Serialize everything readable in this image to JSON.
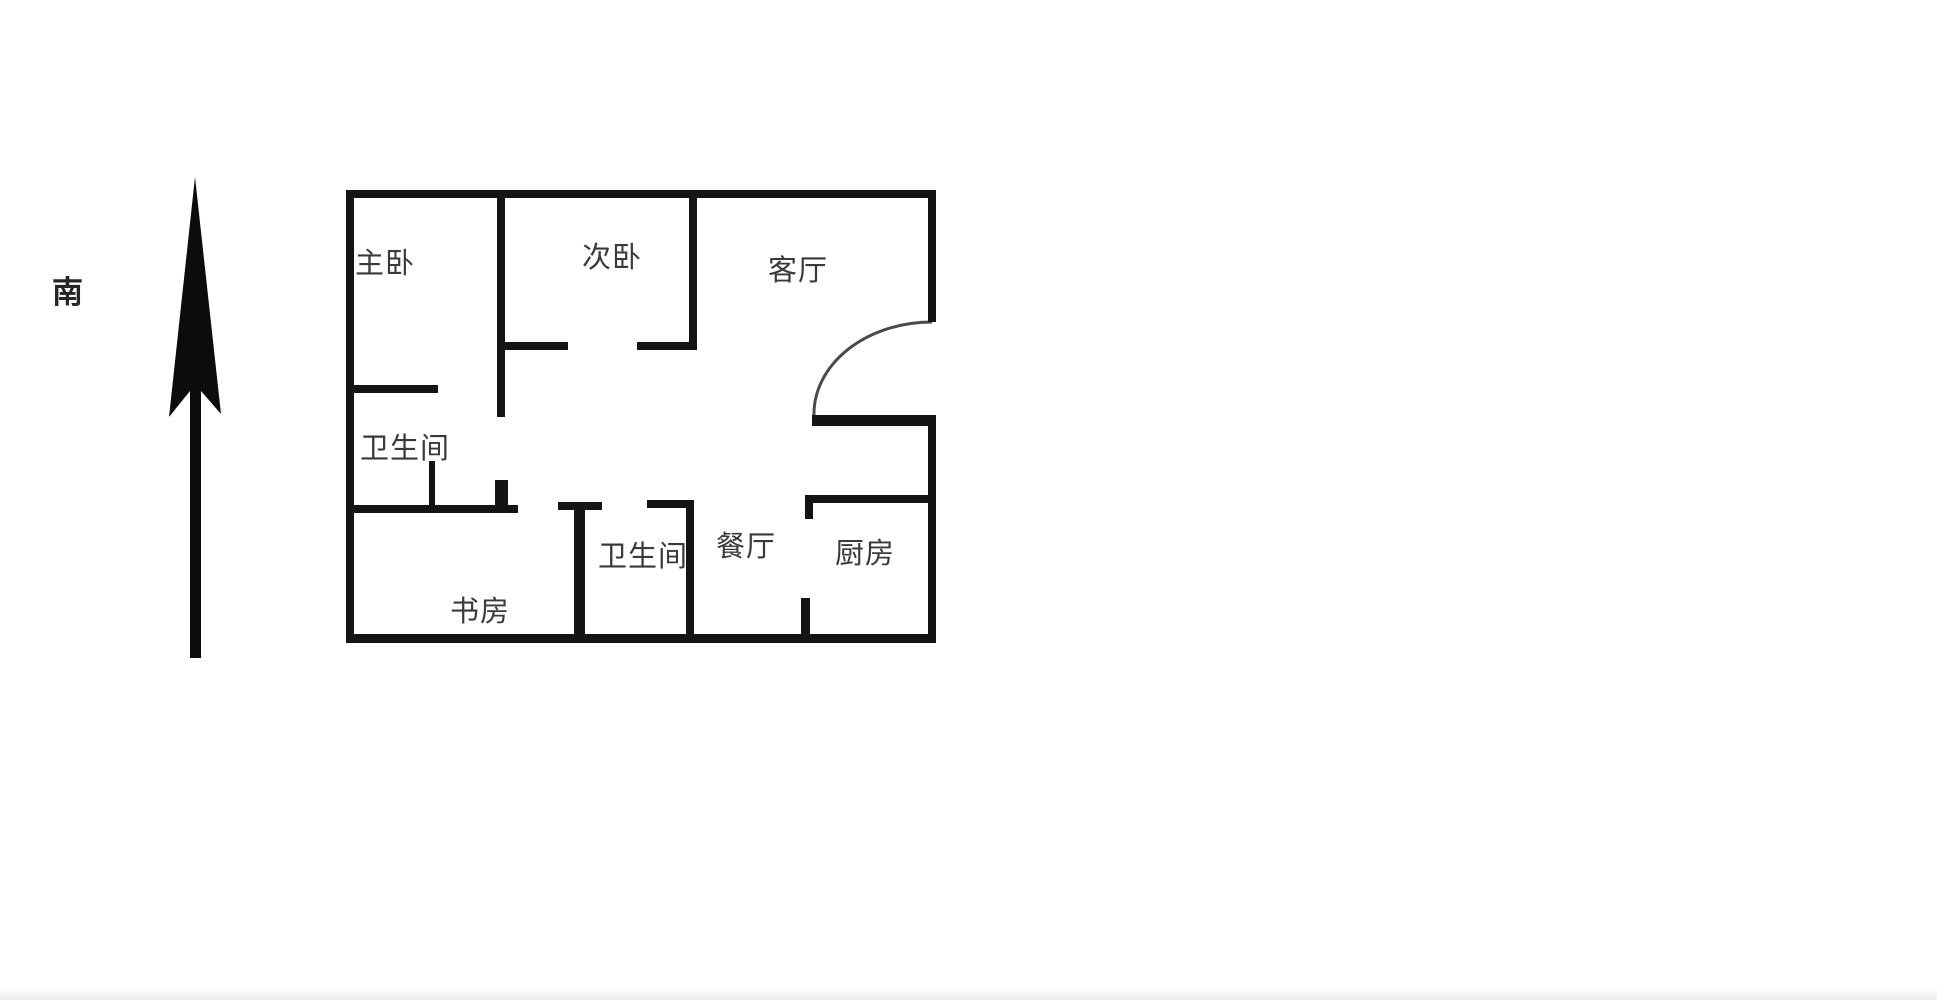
{
  "colors": {
    "background": "#ffffff",
    "wall": "#141414",
    "text": "#3a3a3a",
    "door_arc": "#4a4a4a",
    "compass": "#0c0c0c"
  },
  "compass": {
    "label": "南",
    "label_x": 52,
    "label_y": 277,
    "arrow_points": "195,177 221,414 201,391 201,658 190,658 190,391 169,417"
  },
  "floorplan": {
    "door_arc_path": "M 932 322 A 118 92 0 0 0 814 415",
    "rooms": [
      {
        "id": "master-bedroom",
        "label": "主卧",
        "x": 355,
        "y": 249
      },
      {
        "id": "second-bedroom",
        "label": "次卧",
        "x": 582,
        "y": 243
      },
      {
        "id": "living-room",
        "label": "客厅",
        "x": 768,
        "y": 256
      },
      {
        "id": "bathroom-1",
        "label": "卫生间",
        "x": 360,
        "y": 434
      },
      {
        "id": "bathroom-2",
        "label": "卫生间",
        "x": 598,
        "y": 542
      },
      {
        "id": "dining-room",
        "label": "餐厅",
        "x": 716,
        "y": 532
      },
      {
        "id": "kitchen",
        "label": "厨房",
        "x": 835,
        "y": 539
      },
      {
        "id": "study",
        "label": "书房",
        "x": 450,
        "y": 597
      }
    ],
    "walls": [
      {
        "name": "wall-outer-top",
        "x": 346,
        "y": 190,
        "w": 590,
        "h": 8
      },
      {
        "name": "wall-outer-left",
        "x": 346,
        "y": 190,
        "w": 8,
        "h": 453
      },
      {
        "name": "wall-outer-bottom",
        "x": 346,
        "y": 634,
        "w": 590,
        "h": 9
      },
      {
        "name": "wall-outer-right-upper",
        "x": 928,
        "y": 190,
        "w": 8,
        "h": 132
      },
      {
        "name": "wall-outer-right-lower",
        "x": 928,
        "y": 417,
        "w": 8,
        "h": 226
      },
      {
        "name": "wall-bedroom-divider",
        "x": 497,
        "y": 190,
        "w": 8,
        "h": 227
      },
      {
        "name": "wall-master-bottom",
        "x": 346,
        "y": 385,
        "w": 92,
        "h": 8
      },
      {
        "name": "wall-bedroom2-right",
        "x": 689,
        "y": 190,
        "w": 8,
        "h": 160
      },
      {
        "name": "wall-bedroom2-bottom-left",
        "x": 497,
        "y": 342,
        "w": 71,
        "h": 8
      },
      {
        "name": "wall-bedroom2-bottom-right",
        "x": 637,
        "y": 342,
        "w": 60,
        "h": 8
      },
      {
        "name": "wall-bath1-door-line",
        "x": 429,
        "y": 461,
        "w": 6,
        "h": 46
      },
      {
        "name": "wall-study-top",
        "x": 346,
        "y": 505,
        "w": 172,
        "h": 8
      },
      {
        "name": "wall-study-door-jamb",
        "x": 495,
        "y": 480,
        "w": 13,
        "h": 27
      },
      {
        "name": "wall-entry-hall",
        "x": 812,
        "y": 415,
        "w": 124,
        "h": 11
      },
      {
        "name": "wall-kitchen-top",
        "x": 805,
        "y": 495,
        "w": 131,
        "h": 8
      },
      {
        "name": "wall-kitchen-top-stub",
        "x": 805,
        "y": 495,
        "w": 8,
        "h": 24
      },
      {
        "name": "wall-kitchen-door-stub",
        "x": 801,
        "y": 598,
        "w": 9,
        "h": 38
      },
      {
        "name": "wall-bath2-left",
        "x": 574,
        "y": 502,
        "w": 11,
        "h": 132
      },
      {
        "name": "wall-bath2-top-left",
        "x": 558,
        "y": 502,
        "w": 44,
        "h": 8
      },
      {
        "name": "wall-bath2-top-right",
        "x": 647,
        "y": 500,
        "w": 46,
        "h": 8
      },
      {
        "name": "wall-bath2-right",
        "x": 686,
        "y": 500,
        "w": 8,
        "h": 136
      }
    ]
  }
}
